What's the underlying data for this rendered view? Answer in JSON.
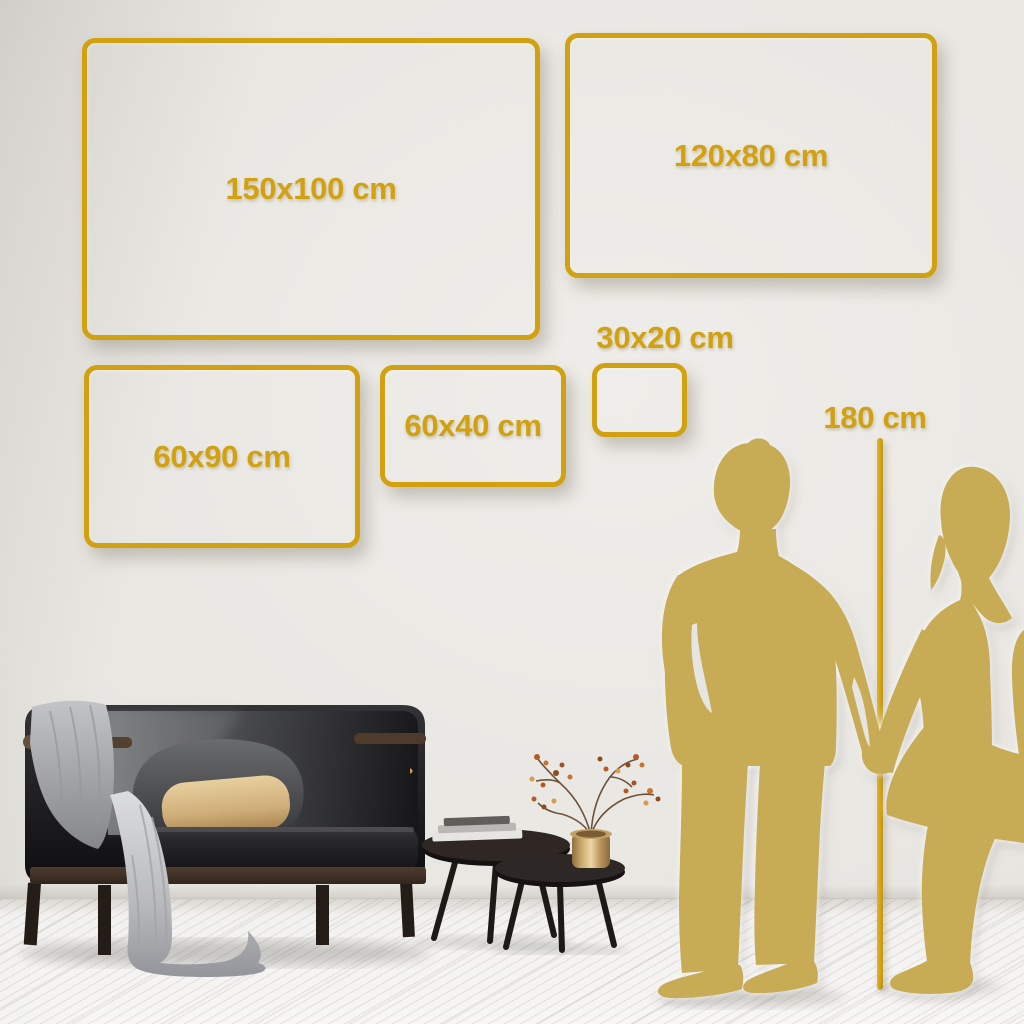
{
  "title": "Wall art size comparison guide",
  "frames": [
    {
      "id": "150x100",
      "label": "150x100 cm"
    },
    {
      "id": "120x80",
      "label": "120x80 cm"
    },
    {
      "id": "60x90",
      "label": "60x90 cm"
    },
    {
      "id": "60x40",
      "label": "60x40 cm"
    },
    {
      "id": "30x20",
      "label": "30x20 cm"
    }
  ],
  "height_marker": {
    "label": "180 cm"
  },
  "colors": {
    "frame_gold": "#D2A112",
    "silhouette_gold": "#C8AC55",
    "wall_light": "#EFEDE9",
    "wall_dark": "#C7C4BE",
    "floor_white": "#F4F3F1"
  },
  "scene_elements": [
    "man-silhouette",
    "woman-silhouette",
    "height-measure-line",
    "sofa",
    "blanket",
    "gray-pillow",
    "beige-pillow",
    "nesting-coffee-tables",
    "books-stack",
    "gold-vase",
    "dried-branch-with-berries"
  ]
}
